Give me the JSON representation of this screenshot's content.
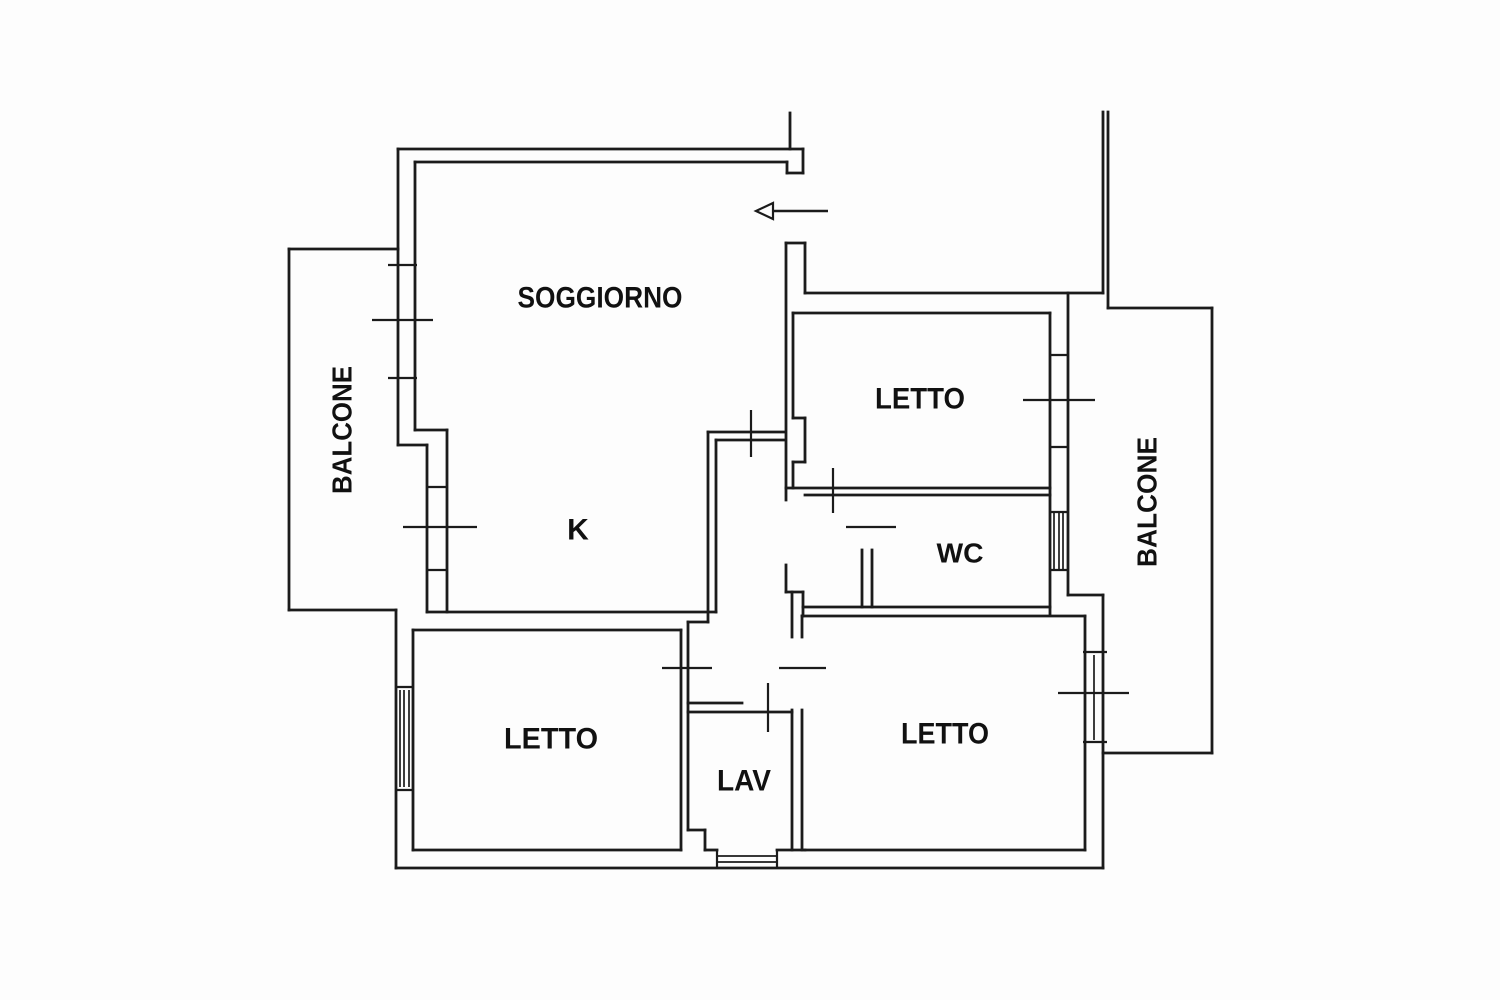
{
  "document": {
    "type": "apartment-floor-plan",
    "colors": {
      "ink": "#1b1b1b",
      "paper": "#fdfdfd"
    }
  },
  "rooms": [
    {
      "id": "soggiorno",
      "label": "SOGGIORNO",
      "x": 600,
      "y": 298,
      "rotate": 0,
      "size": 30,
      "tlen": 165
    },
    {
      "id": "kitchen",
      "label": "K",
      "x": 578,
      "y": 530,
      "rotate": 0,
      "size": 30,
      "tlen": 0
    },
    {
      "id": "letto-nord",
      "label": "LETTO",
      "x": 920,
      "y": 399,
      "rotate": 0,
      "size": 30,
      "tlen": 90
    },
    {
      "id": "wc",
      "label": "WC",
      "x": 960,
      "y": 553,
      "rotate": 0,
      "size": 28,
      "tlen": 47
    },
    {
      "id": "letto-ovest",
      "label": "LETTO",
      "x": 551,
      "y": 739,
      "rotate": 0,
      "size": 30,
      "tlen": 94
    },
    {
      "id": "lav",
      "label": "LAV",
      "x": 744,
      "y": 781,
      "rotate": 0,
      "size": 30,
      "tlen": 54
    },
    {
      "id": "letto-est",
      "label": "LETTO",
      "x": 945,
      "y": 734,
      "rotate": 0,
      "size": 30,
      "tlen": 88
    },
    {
      "id": "balcone-ovest",
      "label": "BALCONE",
      "x": 342,
      "y": 430,
      "rotate": -90,
      "size": 28,
      "tlen": 128
    },
    {
      "id": "balcone-est",
      "label": "BALCONE",
      "x": 1147,
      "y": 502,
      "rotate": -90,
      "size": 28,
      "tlen": 130
    }
  ],
  "plan": {
    "walls": [
      [
        398,
        149,
        803,
        149
      ],
      [
        803,
        149,
        803,
        173
      ],
      [
        787,
        173,
        803,
        173
      ],
      [
        787,
        162,
        787,
        173
      ],
      [
        415,
        162,
        787,
        162
      ],
      [
        790,
        113,
        790,
        149
      ],
      [
        398,
        149,
        398,
        445
      ],
      [
        415,
        162,
        415,
        430
      ],
      [
        398,
        445,
        427,
        445
      ],
      [
        415,
        430,
        447,
        430
      ],
      [
        427,
        445,
        427,
        612
      ],
      [
        447,
        430,
        447,
        612
      ],
      [
        289,
        249,
        398,
        249
      ],
      [
        289,
        249,
        289,
        610
      ],
      [
        289,
        610,
        396,
        610
      ],
      [
        396,
        610,
        396,
        868
      ],
      [
        413,
        630,
        413,
        850
      ],
      [
        396,
        868,
        1103,
        868
      ],
      [
        413,
        850,
        681,
        850
      ],
      [
        705,
        850,
        717,
        850
      ],
      [
        777,
        850,
        805,
        850
      ],
      [
        805,
        850,
        1085,
        850
      ],
      [
        427,
        612,
        716,
        612
      ],
      [
        413,
        630,
        681,
        630
      ],
      [
        681,
        630,
        681,
        850
      ],
      [
        688,
        622,
        688,
        830
      ],
      [
        688,
        622,
        708,
        622
      ],
      [
        688,
        830,
        705,
        830
      ],
      [
        705,
        830,
        705,
        850
      ],
      [
        708,
        432,
        708,
        622
      ],
      [
        716,
        440,
        716,
        612
      ],
      [
        708,
        432,
        785,
        432
      ],
      [
        716,
        440,
        785,
        440
      ],
      [
        786,
        243,
        805,
        243
      ],
      [
        805,
        243,
        805,
        293
      ],
      [
        786,
        243,
        786,
        500
      ],
      [
        793,
        313,
        793,
        418
      ],
      [
        793,
        418,
        805,
        418
      ],
      [
        805,
        418,
        805,
        462
      ],
      [
        793,
        462,
        805,
        462
      ],
      [
        793,
        462,
        793,
        488
      ],
      [
        805,
        293,
        1103,
        293
      ],
      [
        793,
        313,
        1050,
        313
      ],
      [
        1103,
        112,
        1103,
        293
      ],
      [
        1108,
        112,
        1108,
        308
      ],
      [
        1050,
        313,
        1050,
        615
      ],
      [
        1068,
        293,
        1068,
        595
      ],
      [
        1108,
        308,
        1212,
        308
      ],
      [
        1212,
        308,
        1212,
        753
      ],
      [
        1103,
        753,
        1212,
        753
      ],
      [
        1068,
        595,
        1103,
        595
      ],
      [
        1103,
        595,
        1103,
        868
      ],
      [
        1085,
        616,
        1085,
        850
      ],
      [
        803,
        607,
        1050,
        607
      ],
      [
        802,
        616,
        1085,
        616
      ],
      [
        862,
        550,
        862,
        607
      ],
      [
        872,
        550,
        872,
        607
      ],
      [
        786,
        488,
        1050,
        488
      ],
      [
        805,
        495,
        1050,
        495
      ],
      [
        786,
        565,
        786,
        592
      ],
      [
        786,
        592,
        803,
        592
      ],
      [
        803,
        592,
        803,
        616
      ],
      [
        792,
        592,
        792,
        637
      ],
      [
        802,
        616,
        802,
        637
      ],
      [
        792,
        710,
        792,
        850
      ],
      [
        802,
        710,
        802,
        850
      ],
      [
        688,
        703,
        742,
        703
      ],
      [
        688,
        712,
        792,
        712
      ]
    ],
    "door_ticks": [
      [
        751,
        410,
        751,
        457
      ],
      [
        833,
        468,
        833,
        513
      ],
      [
        846,
        527,
        896,
        527
      ],
      [
        662,
        668,
        712,
        668
      ],
      [
        779,
        668,
        826,
        668
      ],
      [
        768,
        683,
        768,
        732
      ]
    ],
    "window_ticks": [
      [
        388,
        265,
        417,
        265
      ],
      [
        372,
        320,
        433,
        320
      ],
      [
        388,
        378,
        417,
        378
      ],
      [
        427,
        487,
        447,
        487
      ],
      [
        403,
        527,
        477,
        527
      ],
      [
        427,
        570,
        447,
        570
      ],
      [
        396,
        687,
        413,
        687
      ],
      [
        396,
        790,
        413,
        790
      ],
      [
        1050,
        355,
        1068,
        355
      ],
      [
        1023,
        400,
        1095,
        400
      ],
      [
        1050,
        447,
        1068,
        447
      ],
      [
        1050,
        512,
        1068,
        512
      ],
      [
        1050,
        570,
        1068,
        570
      ],
      [
        1083,
        652,
        1107,
        652
      ],
      [
        1058,
        693,
        1129,
        693
      ],
      [
        1083,
        742,
        1107,
        742
      ],
      [
        717,
        850,
        717,
        868
      ],
      [
        777,
        850,
        777,
        868
      ]
    ],
    "window_hatch": [
      [
        400,
        690,
        400,
        787
      ],
      [
        404,
        690,
        404,
        787
      ],
      [
        409,
        690,
        409,
        787
      ],
      [
        1054,
        512,
        1054,
        570
      ],
      [
        1059,
        512,
        1059,
        570
      ],
      [
        1063,
        512,
        1063,
        570
      ],
      [
        1094,
        655,
        1094,
        740
      ],
      [
        717,
        856,
        777,
        856
      ],
      [
        717,
        862,
        777,
        862
      ]
    ],
    "entrance_arrow": {
      "tail": [
        772,
        211,
        828,
        211
      ],
      "head": [
        [
          756,
          211
        ],
        [
          773,
          203
        ],
        [
          773,
          219
        ]
      ]
    }
  }
}
